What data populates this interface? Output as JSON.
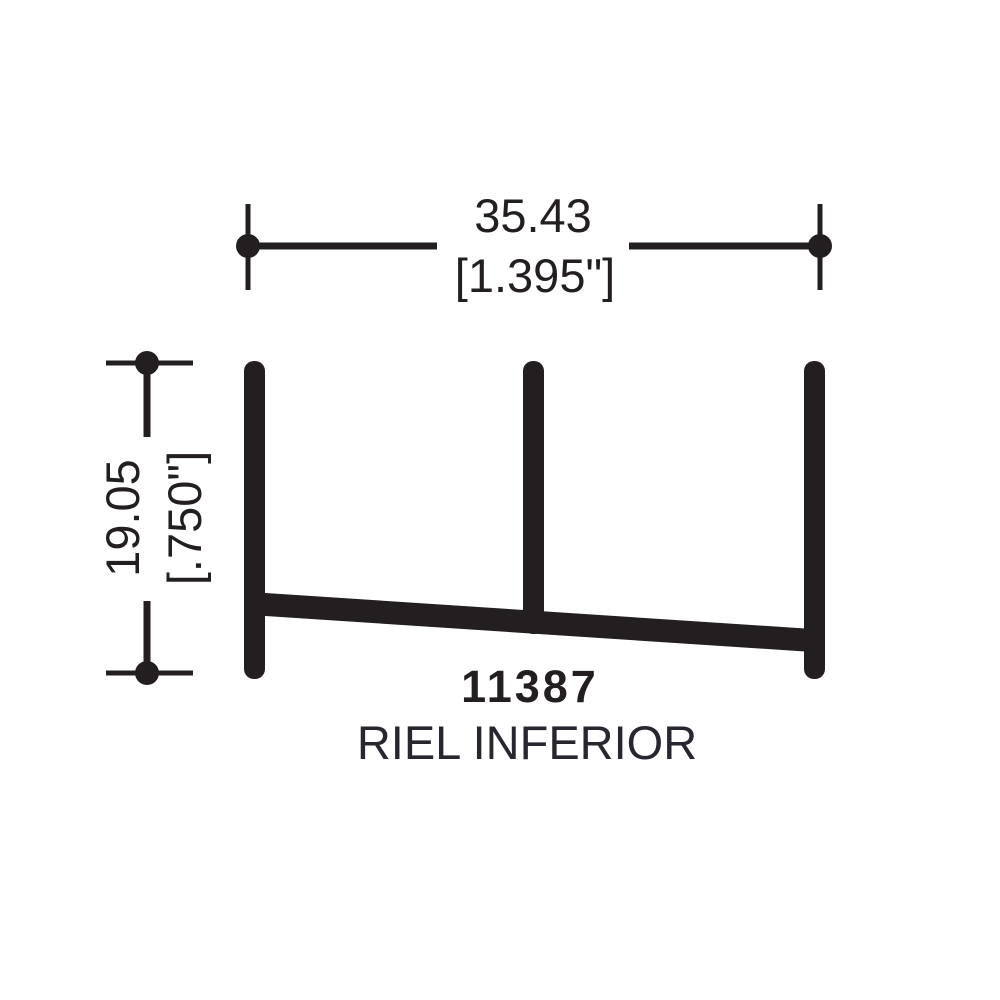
{
  "drawing": {
    "part_number": "11387",
    "part_name": "RIEL INFERIOR",
    "width_dimension": {
      "mm": "35.43",
      "inches": "[1.395\"]"
    },
    "height_dimension": {
      "mm": "19.05",
      "inches": "[.750\"]"
    }
  },
  "colors": {
    "ink": "#231f20",
    "background": "#ffffff"
  }
}
